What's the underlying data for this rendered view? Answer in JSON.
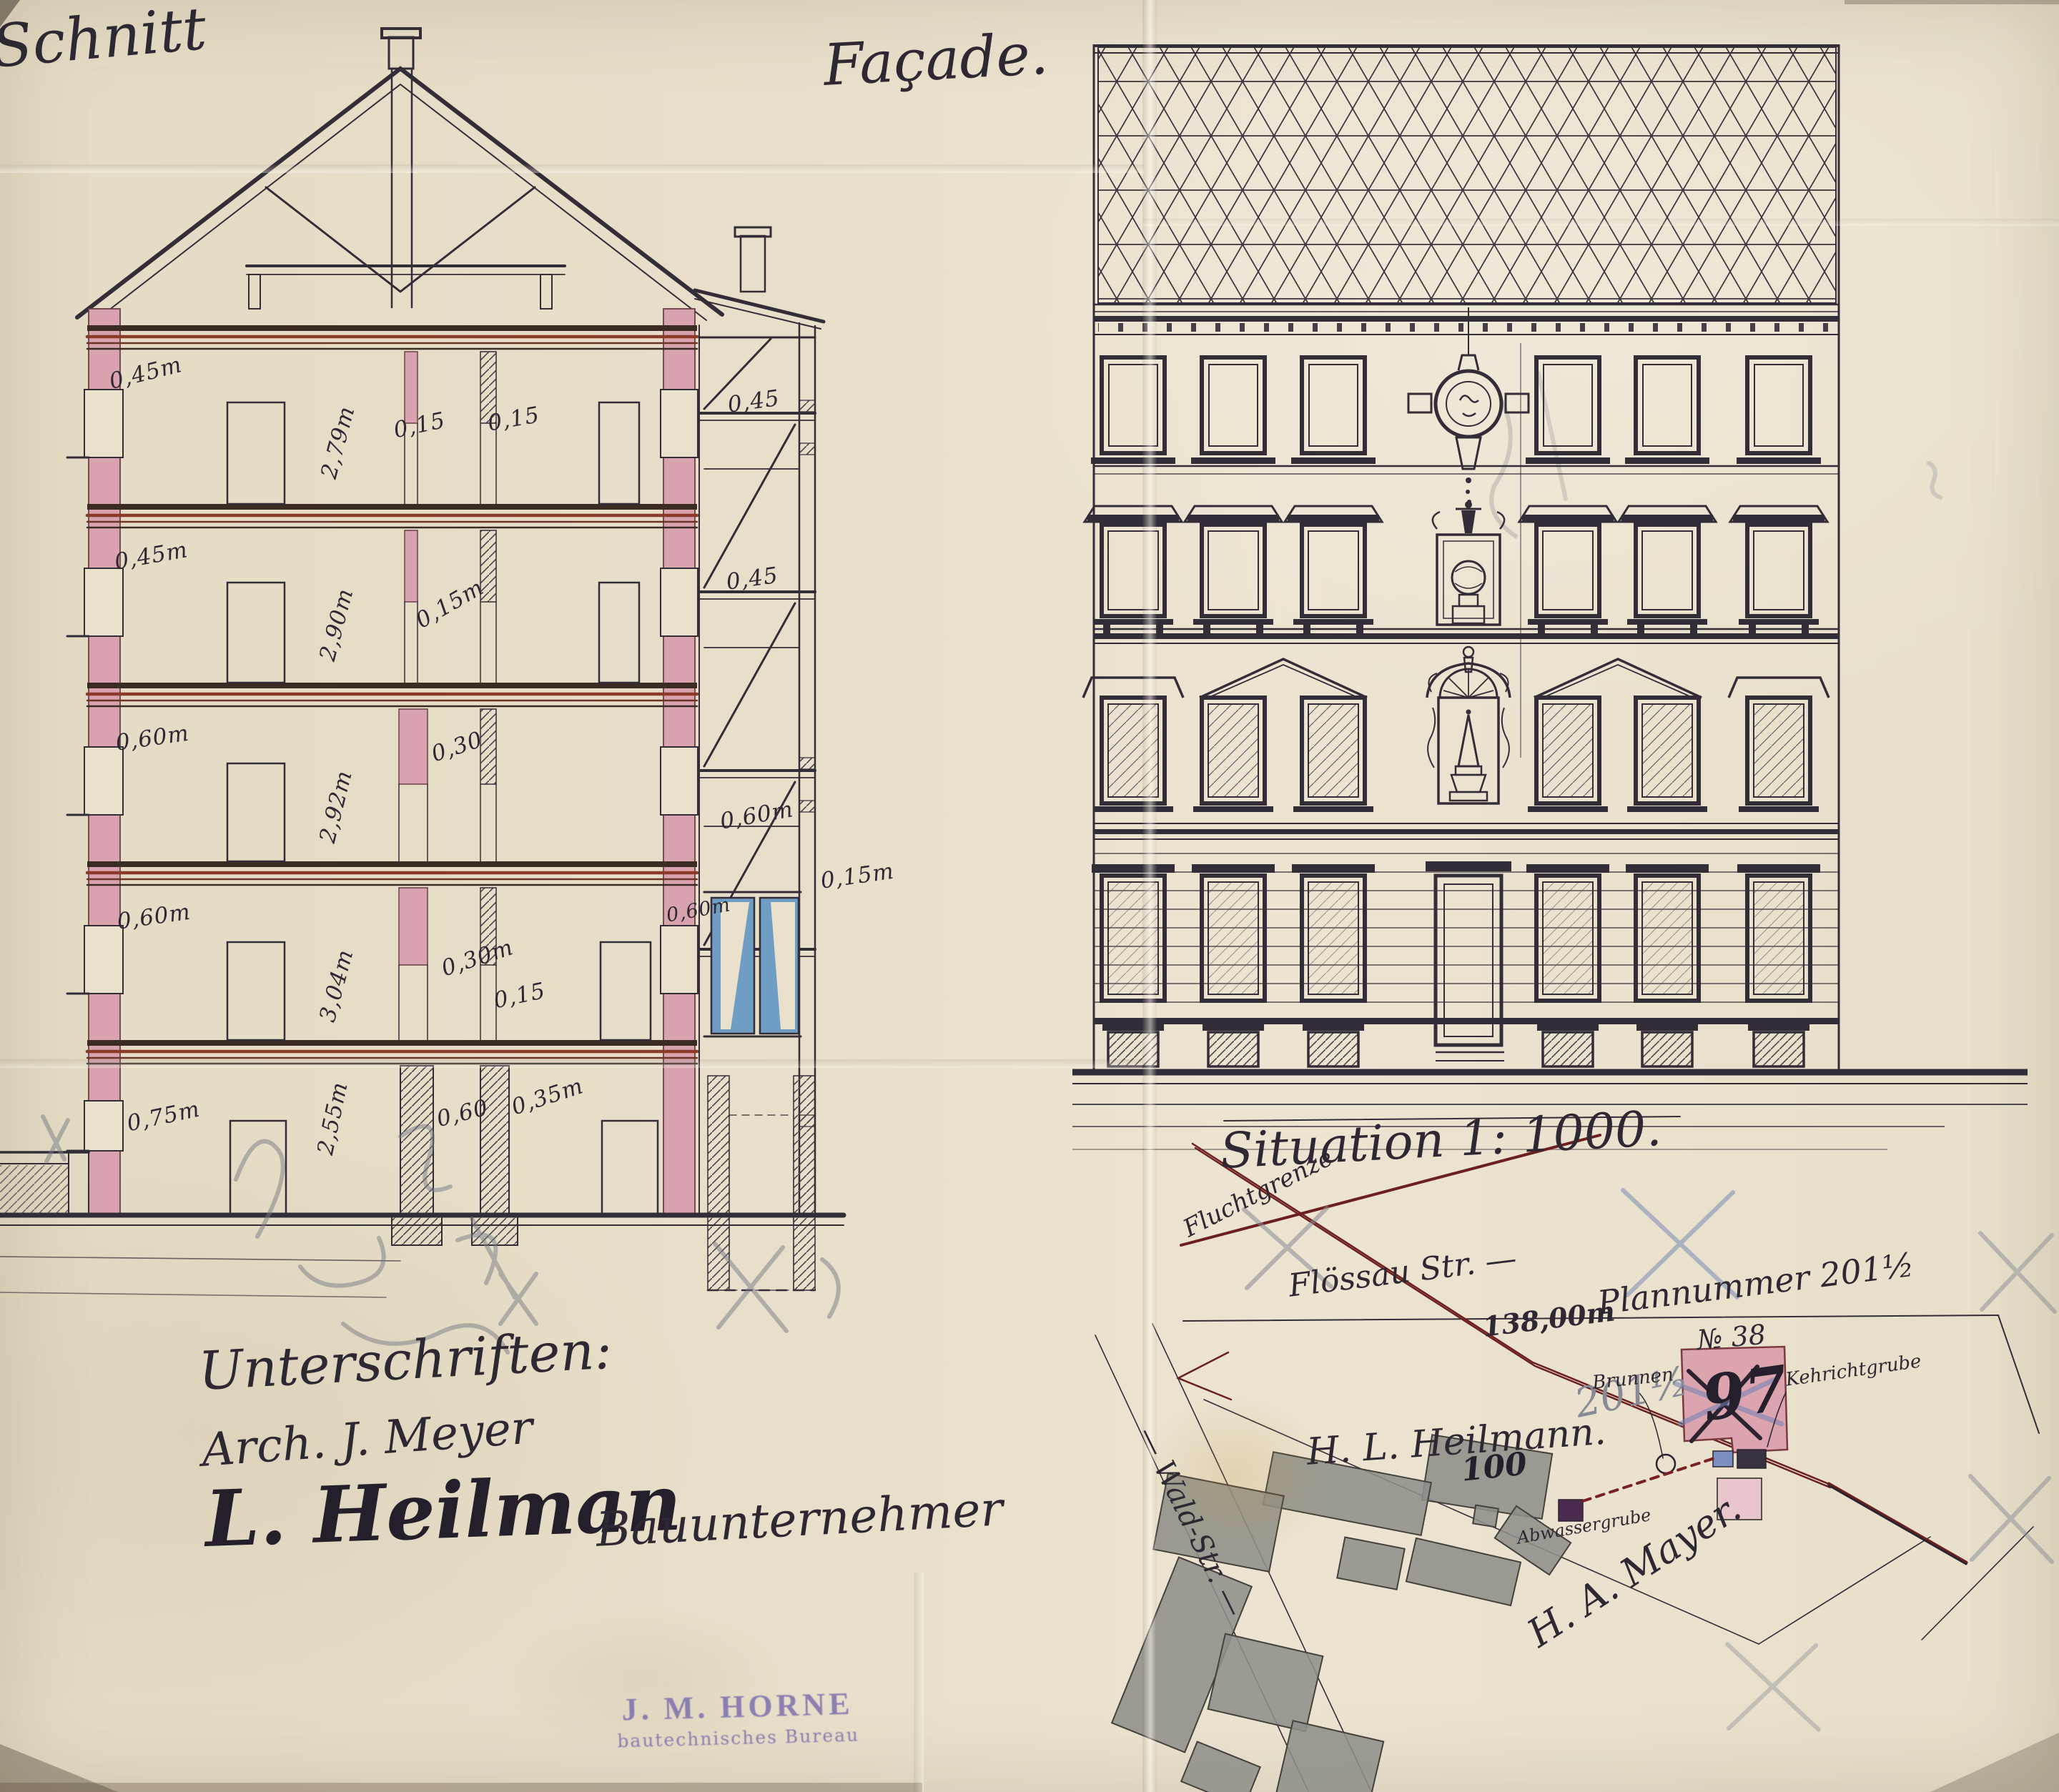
{
  "titles": {
    "section": "Schnitt",
    "facade": "Façade.",
    "situation": "Situation 1: 1000.",
    "situation_note": "Fluchtgrenze"
  },
  "section": {
    "dims": {
      "f5_wall": "0,45m",
      "f5_height": "2,79m",
      "f5_part1": "0,15",
      "f5_part2": "0,15",
      "f5_annex": "0,45",
      "f4_wall": "0,45m",
      "f4_height": "2,90m",
      "f4_part": "0,15m",
      "f4_annex": "0,45",
      "f3_wall": "0,60m",
      "f3_height": "2,92m",
      "f3_part": "0,30",
      "f3_annex": "0,60m",
      "f2_wall": "0,60m",
      "f2_height": "3,04m",
      "f2_part1": "0,30m",
      "f2_part2": "0,15",
      "f2_annex_window": "0,60m",
      "f2_annex_wall": "0,15m",
      "b_wall": "0,75m",
      "b_height": "2,55m",
      "b_pier1": "0,60",
      "b_pier2": "0,35m"
    }
  },
  "site": {
    "street": "Flössau Str. —",
    "length": "138,00m",
    "plan_number": "Plannummer 201½",
    "plot_number": "№ 38",
    "old_number": "97",
    "pencil_number": "201½",
    "owner": "H. L. Heilmann.",
    "neighbor": "H. A. Mayer.",
    "building_number": "100",
    "side_street": "— Wald-Str. —",
    "well": "Brunnen",
    "refuse_pit": "Kehrichtgrube",
    "cesspit": "Abwassergrube"
  },
  "signatures": {
    "heading": "Unterschriften:",
    "architect": "Arch. J. Meyer",
    "owner": "L. Heilman",
    "owner_role": "Bauunternehmer"
  },
  "stamp": {
    "line1": "J. M. HORNE",
    "line2": "bautechnisches Bureau"
  },
  "colors": {
    "paper": "#e8dfca",
    "ink": "#332d38",
    "wall_pink": "#d8a3ae",
    "floor_red": "#8a3a26",
    "window_blue": "#6f9dc3",
    "site_red_line": "#6d1f20",
    "building_gray": "#908f8a",
    "stamp_purple": "#685ca8"
  }
}
